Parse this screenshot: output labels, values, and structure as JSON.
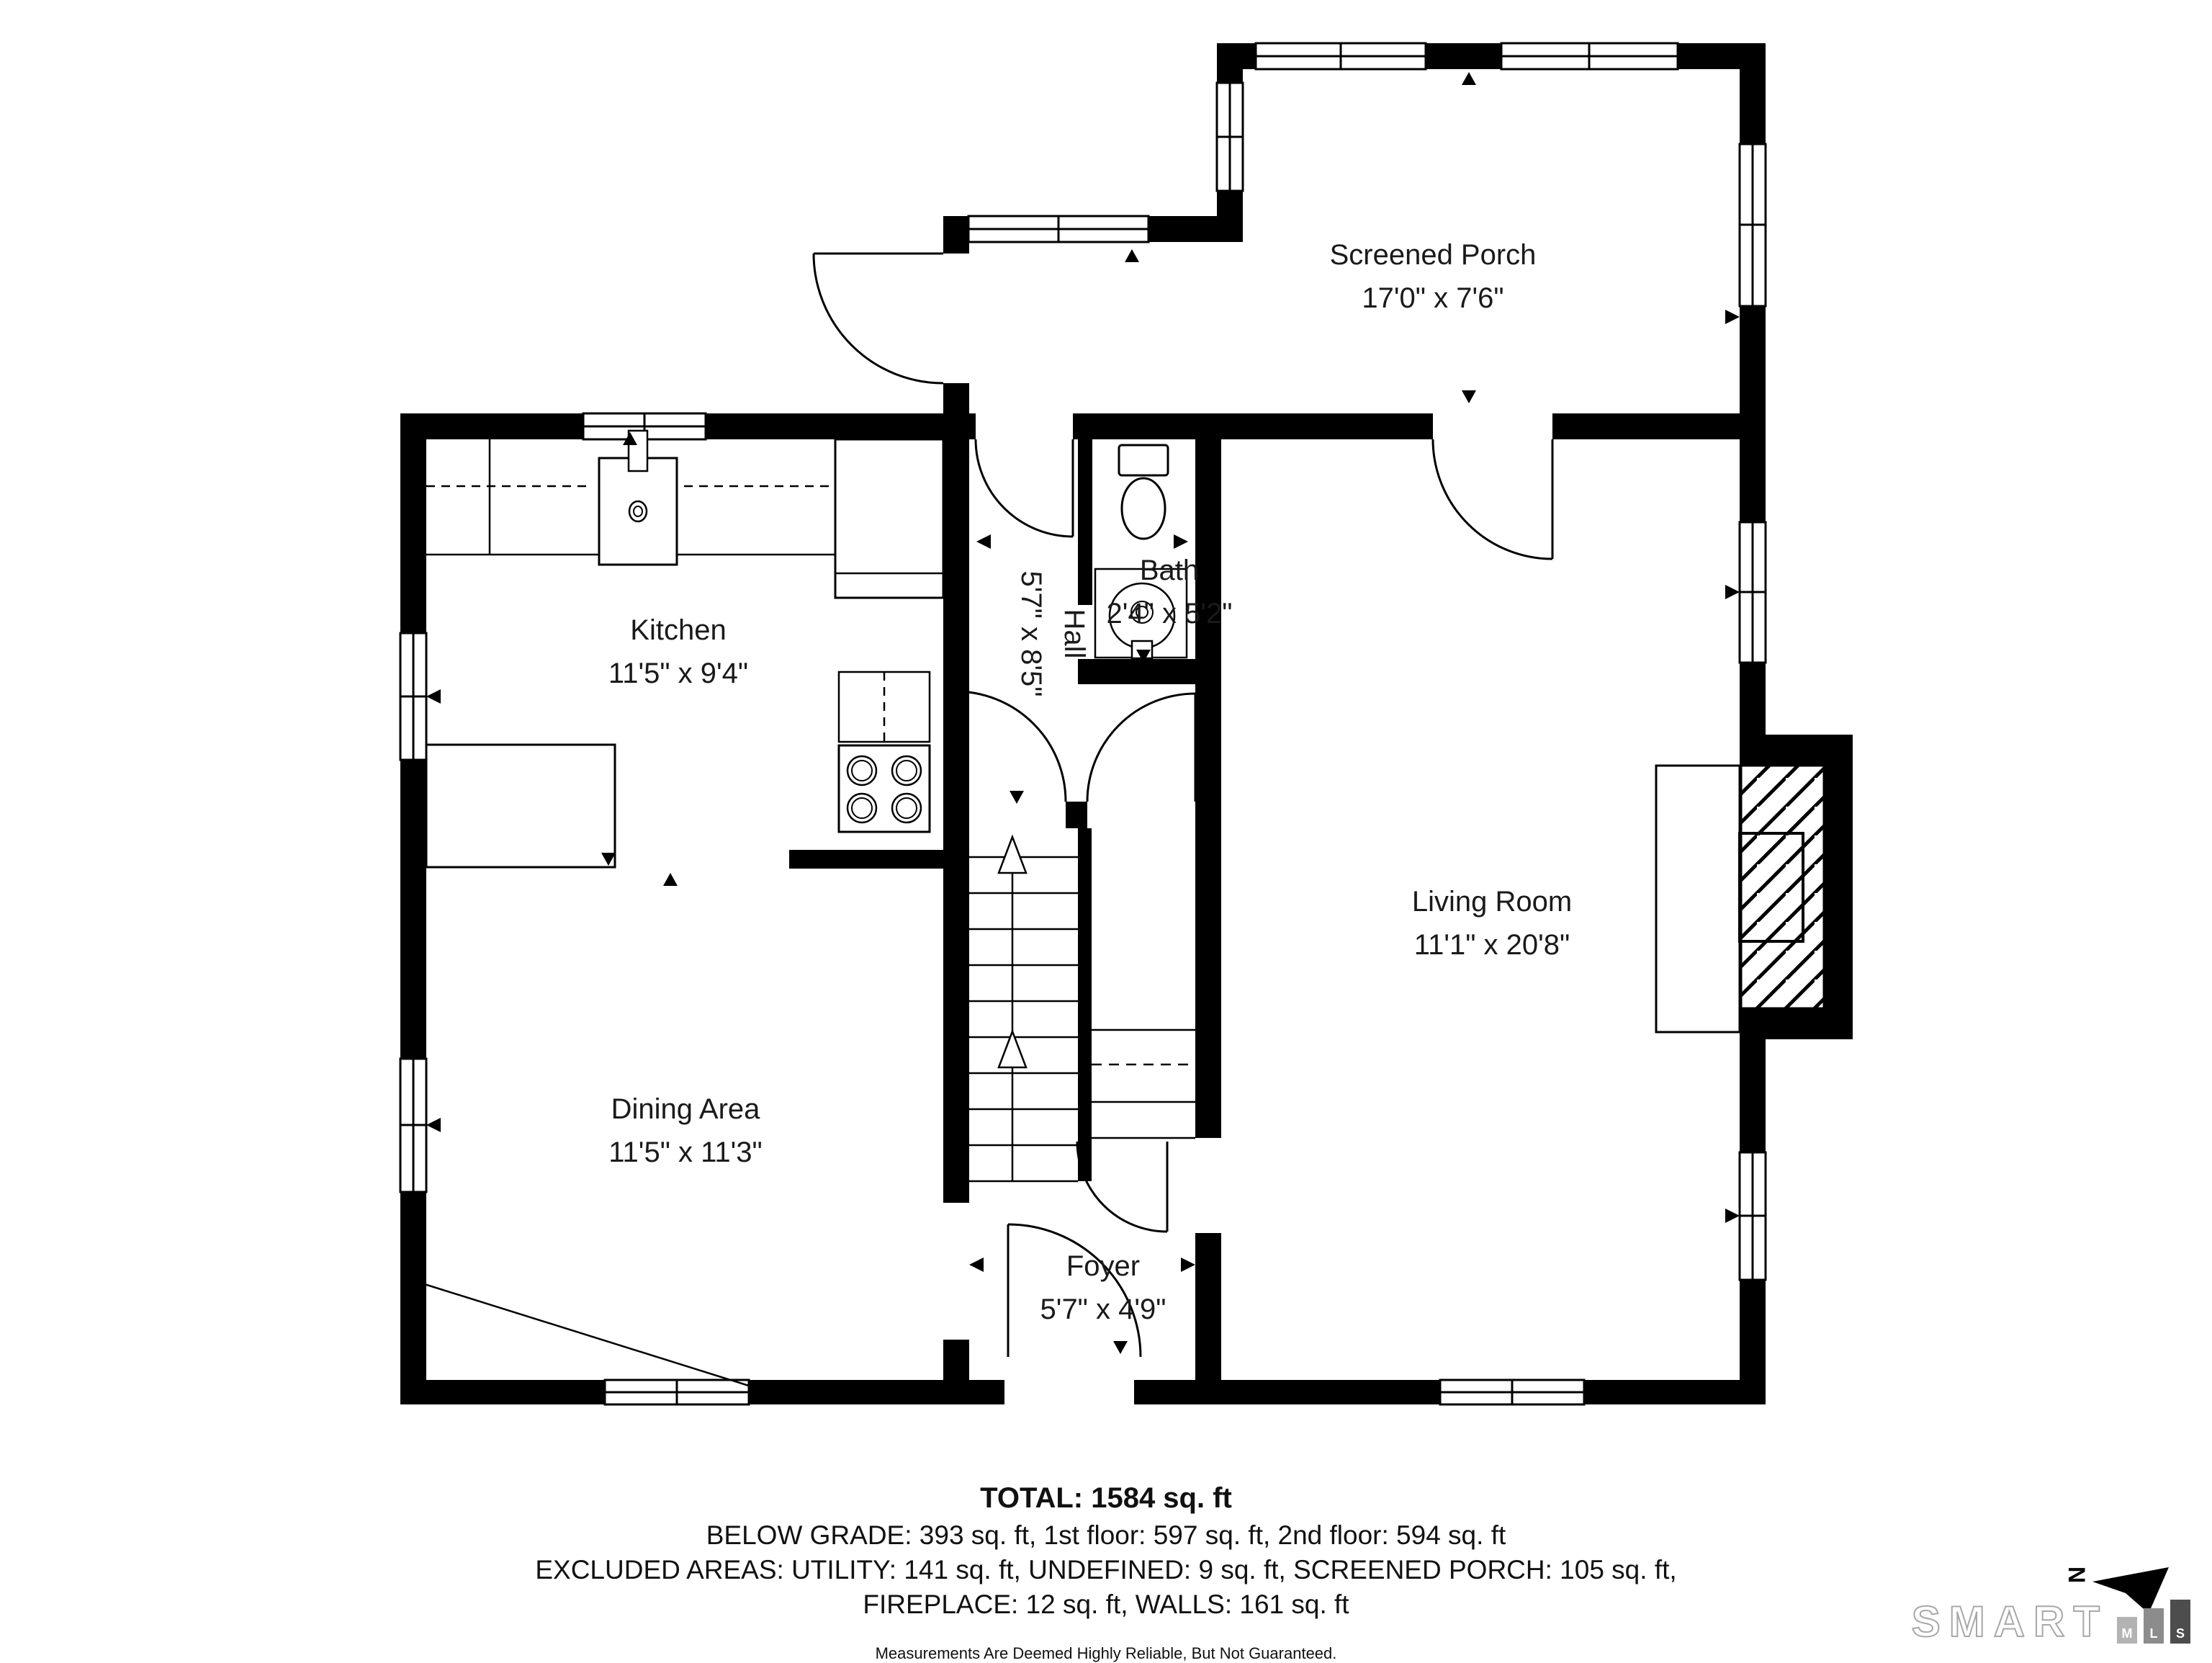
{
  "rooms": {
    "screened_porch": {
      "name": "Screened Porch",
      "dims": "17'0\" x 7'6\""
    },
    "kitchen": {
      "name": "Kitchen",
      "dims": "11'5\" x 9'4\""
    },
    "bath": {
      "name": "Bath",
      "dims": "2'4\" x 5'2\""
    },
    "hall": {
      "name": "Hall",
      "dims": "5'7\" x 8'5\""
    },
    "living_room": {
      "name": "Living Room",
      "dims": "11'1\" x 20'8\""
    },
    "dining_area": {
      "name": "Dining Area",
      "dims": "11'5\" x 11'3\""
    },
    "foyer": {
      "name": "Foyer",
      "dims": "5'7\" x 4'9\""
    }
  },
  "summary": {
    "total": "TOTAL: 1584 sq. ft",
    "floors": "BELOW GRADE: 393 sq. ft, 1st floor: 597 sq. ft, 2nd floor: 594 sq. ft",
    "excluded_1": "EXCLUDED AREAS: UTILITY: 141 sq. ft, UNDEFINED: 9 sq. ft, SCREENED PORCH: 105 sq. ft,",
    "excluded_2": "FIREPLACE: 12 sq. ft, WALLS: 161 sq. ft",
    "disclaimer": "Measurements Are Deemed Highly Reliable, But Not Guaranteed."
  },
  "branding": {
    "name": "SMART",
    "mls": [
      "M",
      "L",
      "S"
    ]
  },
  "compass": {
    "label": "N"
  },
  "colors": {
    "wall": "#000000",
    "background": "#ffffff",
    "text": "#1a1a1a",
    "brand_outline": "#a8a8a8",
    "bar_m": "#b3b3b3",
    "bar_l": "#8c8c8c",
    "bar_s": "#4d4d4d"
  }
}
